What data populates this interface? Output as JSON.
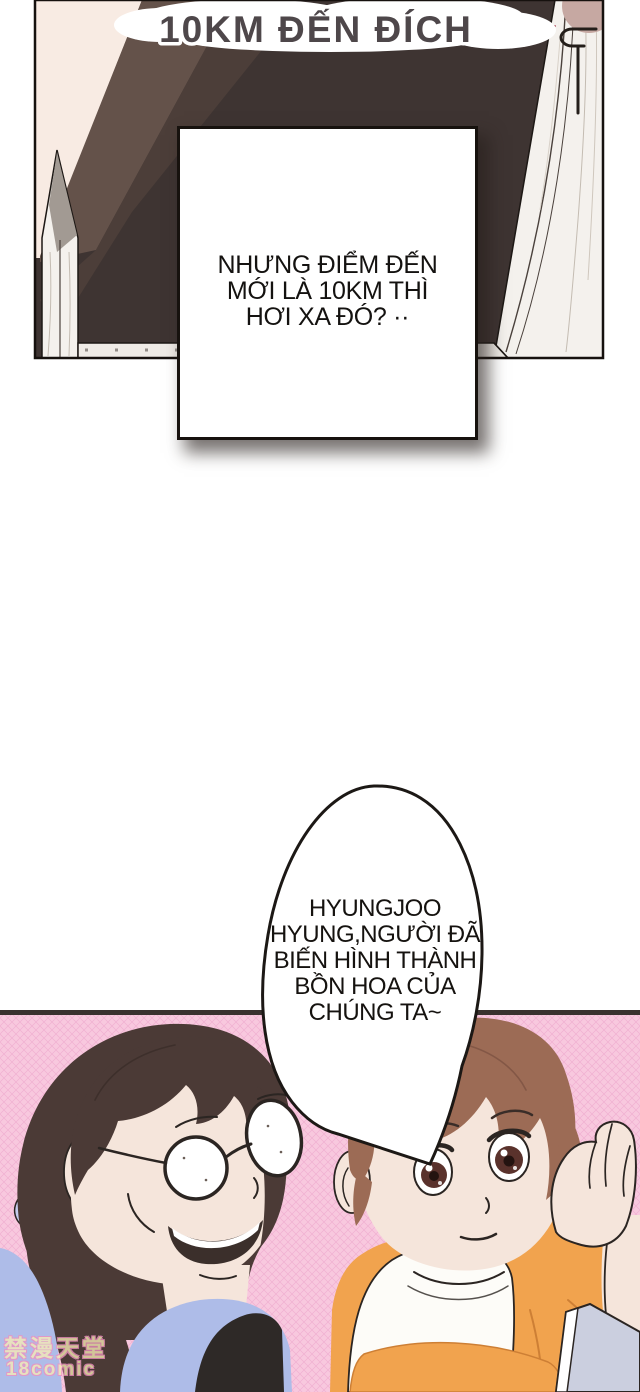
{
  "comic": {
    "title": "10KM ĐẾN ĐÍCH",
    "panel1": {
      "speech_box_text": "NHƯNG ĐIỂM ĐẾN\nMỚI LÀ 10KM THÌ\nHƠI XA ĐÓ? ··"
    },
    "panel2": {
      "bubble_text": "HYUNGJOO\nHYUNG,NGƯỜI ĐÃ\nBIẾN HÌNH THÀNH\nBỒN HOA CỦA\nCHÚNG TA~"
    },
    "watermark": {
      "line1": "禁漫天堂",
      "line2": "18comic"
    },
    "colors": {
      "panel_dark": "#3e3432",
      "panel_band": "#5a4a42",
      "cream_wall": "#f8ebe3",
      "frame_white": "#f4f1ed",
      "rose_circle": "#c6a8a2",
      "pink_line": "#b4606e",
      "title_fill": "#4e474a",
      "bottom_pink": "#f8c8de",
      "hatch_pink": "#eb9fc9",
      "hair_left": "#4b3a36",
      "hair_right": "#9c6b55",
      "skin": "#f5e5db",
      "jacket_blue": "#aebce8",
      "hairband_blue": "#c5cced",
      "undershirt": "#2e2927",
      "hoodie_orange": "#f1a34e",
      "tee_white": "#fdfcf8",
      "tablet_gray": "#cbcfdf",
      "slate_blue": "#8e96b5",
      "outline": "#2b2522"
    }
  }
}
